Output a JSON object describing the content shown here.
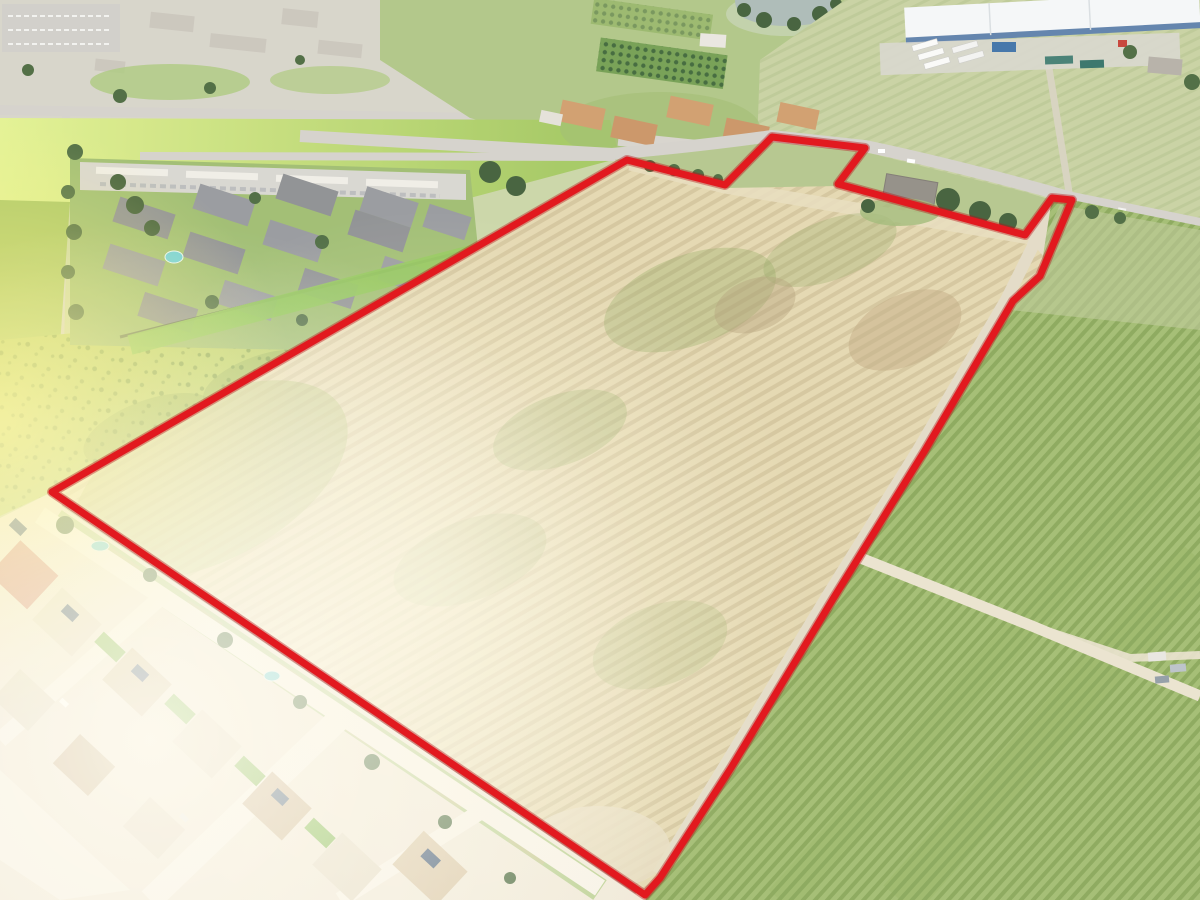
{
  "scene": {
    "title": "Aerial drone photo of farmland parcel with red property boundary outline",
    "regions": [
      "residential neighborhood top-left",
      "apartment complex left",
      "bright green pasture",
      "mottled green field",
      "tilled parcel with crop rows (subject property)",
      "vineyard rows right",
      "industrial warehouse top-right",
      "orchard blocks top",
      "pond top-center",
      "suburban homes with solar panels bottom-left",
      "rural road top-right"
    ]
  },
  "boundary": {
    "points": "52,492 627,160 725,185 772,137 865,148 838,184 1025,235 1052,198 1072,200 1040,276 1013,301 924,452 833,599 731,768 660,878 645,895",
    "color": "#e2191f",
    "shadow_color": "#b50f14",
    "stroke_width": 7,
    "shadow_width": 10
  },
  "colors": {
    "main_field_base": "#e4d7ae",
    "main_field_row": "#c8b78c",
    "headland": "#e8ddbc",
    "corridor_road": "#e2dac4",
    "vineyard_base": "#a0bb6d",
    "vineyard_row": "#7e9d4e",
    "pale_field": "#c6d09f",
    "pale_field_row": "#b2c088",
    "grass_bright_1": "#e2f18e",
    "grass_bright_2": "#a2c75d",
    "grass_mottled": "#b9ce62",
    "speckle": "#74953f",
    "farm_band": "#aec483",
    "urban_base": "#d6d3c8",
    "road_gray": "#d3d0ca",
    "dirt_road": "#eae2cd",
    "suburb_ground": "#f1e9d8",
    "suburb_street": "#f8f3e7",
    "water": "#a9b8b4",
    "warehouse_roof": "#f5f7f8",
    "warehouse_trim": "#5a7da8",
    "track_lanes": "#5d7d92",
    "track_infield": "#bca387",
    "orchard_green": "#6f9b4c",
    "orchard_dot": "#3a6233",
    "included_house_roof": "#7d4f41",
    "excluded_house_roof": "#8f8a82",
    "lot_lawn": "#8fb35f"
  }
}
